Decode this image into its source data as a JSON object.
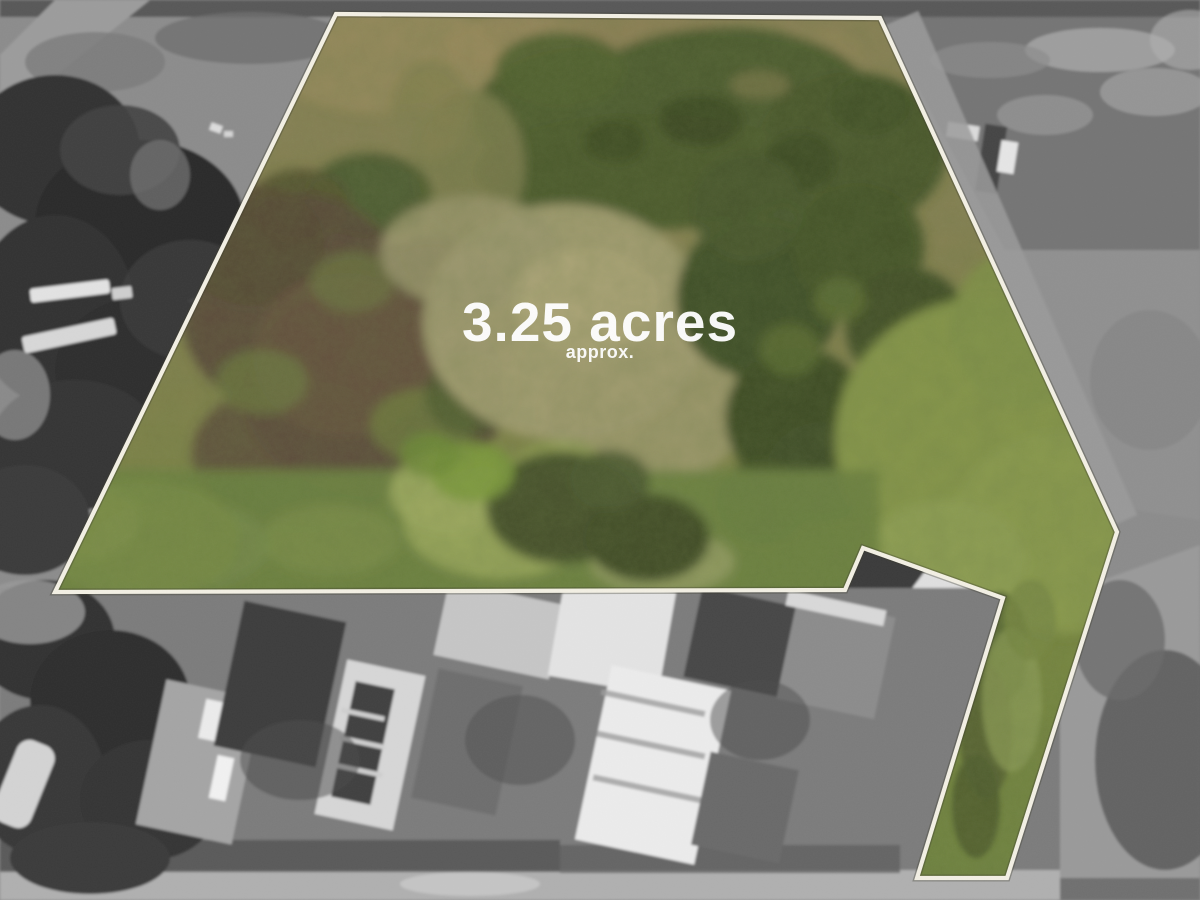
{
  "parcel": {
    "area_label": "3.25 acres",
    "area_qualifier": "approx.",
    "outline_points": "336,14 880,18 1117,532 1007,878 917,878 1003,598 863,548 845,590 55,592",
    "outline_color": "#f3f0e4",
    "label_color": "#ffffff"
  },
  "photo": {
    "inside_palette": {
      "grass_bright": "#87974b",
      "grass_mid": "#6e8340",
      "field_tan": "#a59f74",
      "scrub_brown": "#594a39",
      "trees_dark": "#3e4d26",
      "shrub_olive": "#4d5b2e"
    },
    "outside_palette": {
      "base_gray": "#8c8c8c",
      "road_light": "#b0b0b0",
      "trees_dark_gray": "#303030",
      "roof_white": "#e4e4e4",
      "roof_dark": "#3e3e3e"
    }
  }
}
